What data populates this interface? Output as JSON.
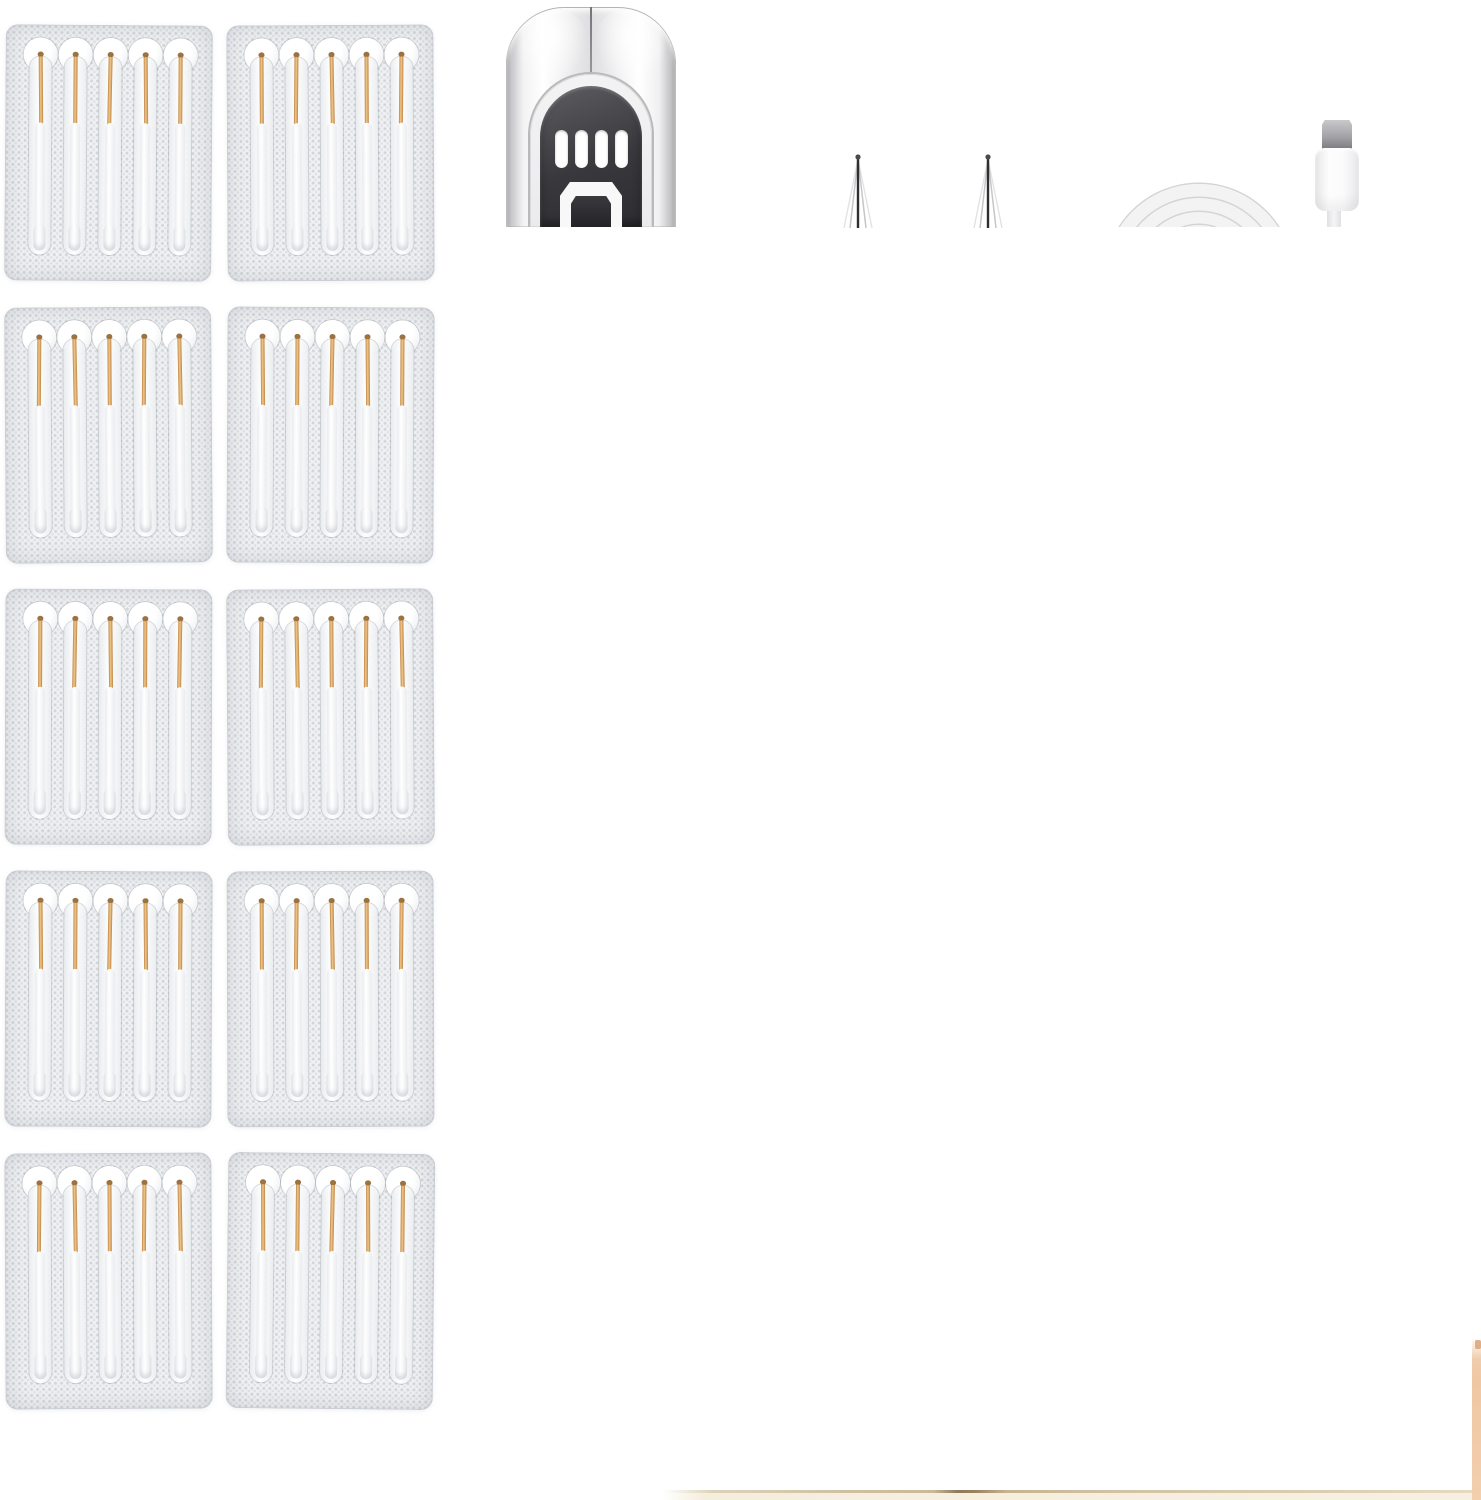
{
  "page": {
    "width": 1481,
    "height": 1500,
    "background": "#ffffff",
    "description": "Product photo collage: electric ear-wax-removal kit with replacement swab blister packs, chrome device head, two needle probe tips and a white USB charging cable; neighbouring collage images are cropped at the bottom-right edges"
  },
  "swab_packs": {
    "count": 10,
    "rows": 5,
    "columns": 2,
    "swabs_per_pack": 5,
    "pack_width": 207,
    "pack_height": 256,
    "col_x": [
      5,
      227
    ],
    "row_y": [
      25,
      307,
      589,
      871,
      1153
    ],
    "rotations_deg": [
      0.4,
      -0.3,
      -0.4,
      0.3,
      0.2,
      -0.4,
      0.3,
      -0.2,
      -0.3,
      0.6
    ],
    "first_swab_center_x": 35,
    "swab_spacing": 35,
    "needle_base_len": 70,
    "colors": {
      "pack_bg": "#f0f1f3",
      "pack_dot": "rgba(131,139,150,0.28)",
      "channel_line": "rgba(150,156,164,0.38)",
      "gold_light": "#f0c887",
      "gold_dark": "#bf8345",
      "gold_tip": "#9b7240",
      "shaft_light": "#ffffff",
      "shaft_shade": "#e9ebed"
    }
  },
  "device": {
    "x": 506,
    "y": 7,
    "width": 170,
    "height": 220,
    "vent_slot_count": 4,
    "colors": {
      "chrome_dark": "#8e8e91",
      "chrome_mid": "#dedee0",
      "chrome_white": "#ffffff",
      "seam": "#74747a",
      "arch_fill": "#f3f3f4",
      "arch_line": "#b9b9bc",
      "panel_light": "#5d5d62",
      "panel_dark": "#2d2d31",
      "slot_white": "#ffffff",
      "opening_frame": "#f8f8f9",
      "opening_dark": "#232327"
    }
  },
  "needle_tips": {
    "count": 2,
    "centers_x": [
      858,
      988
    ],
    "top_y": 152,
    "height": 76,
    "colors": {
      "ball": "#4a4a4c",
      "shaft": "#2f2f31",
      "cone": "#c7c7ca",
      "cone_faint": "#e3e3e5"
    }
  },
  "usb_cable": {
    "coil": {
      "x": 1103,
      "y": 181,
      "width": 192,
      "height": 46,
      "rings": [
        {
          "d": 188,
          "left": 2,
          "top": 3
        },
        {
          "d": 158,
          "left": 17,
          "top": 17
        },
        {
          "d": 128,
          "left": 32,
          "top": 31
        },
        {
          "d": 98,
          "left": 47,
          "top": 44
        }
      ]
    },
    "connector": {
      "type": "micro-usb",
      "metal": {
        "x": 1322,
        "y": 120,
        "w": 30,
        "h": 29
      },
      "body": {
        "x": 1315,
        "y": 148,
        "w": 44,
        "h": 63
      },
      "stub": {
        "x": 1327,
        "y": 211,
        "w": 14,
        "h": 16
      }
    },
    "colors": {
      "ring": "#f3f3f4",
      "ring_edge": "#d4d4d6",
      "metal_light": "#c9c9cc",
      "metal": "#a0a0a4",
      "metal_dark": "#7b7b80",
      "body": "#fdfdfd",
      "body_shade": "#e8e8ea",
      "stub": "#f5f5f6"
    }
  },
  "cropped_edges": {
    "bottom_band": {
      "x": 663,
      "y": 1490,
      "width": 818,
      "height": 10
    },
    "right_band": {
      "x": 1472,
      "y": 1337,
      "width": 9,
      "height": 163
    },
    "colors": {
      "band_line": "#cbb897",
      "band_line_dark": "#8e7a61",
      "band_fill": "#f7f0e0",
      "right_band": "#efc7a3",
      "right_band_deep": "#d9a377"
    }
  }
}
